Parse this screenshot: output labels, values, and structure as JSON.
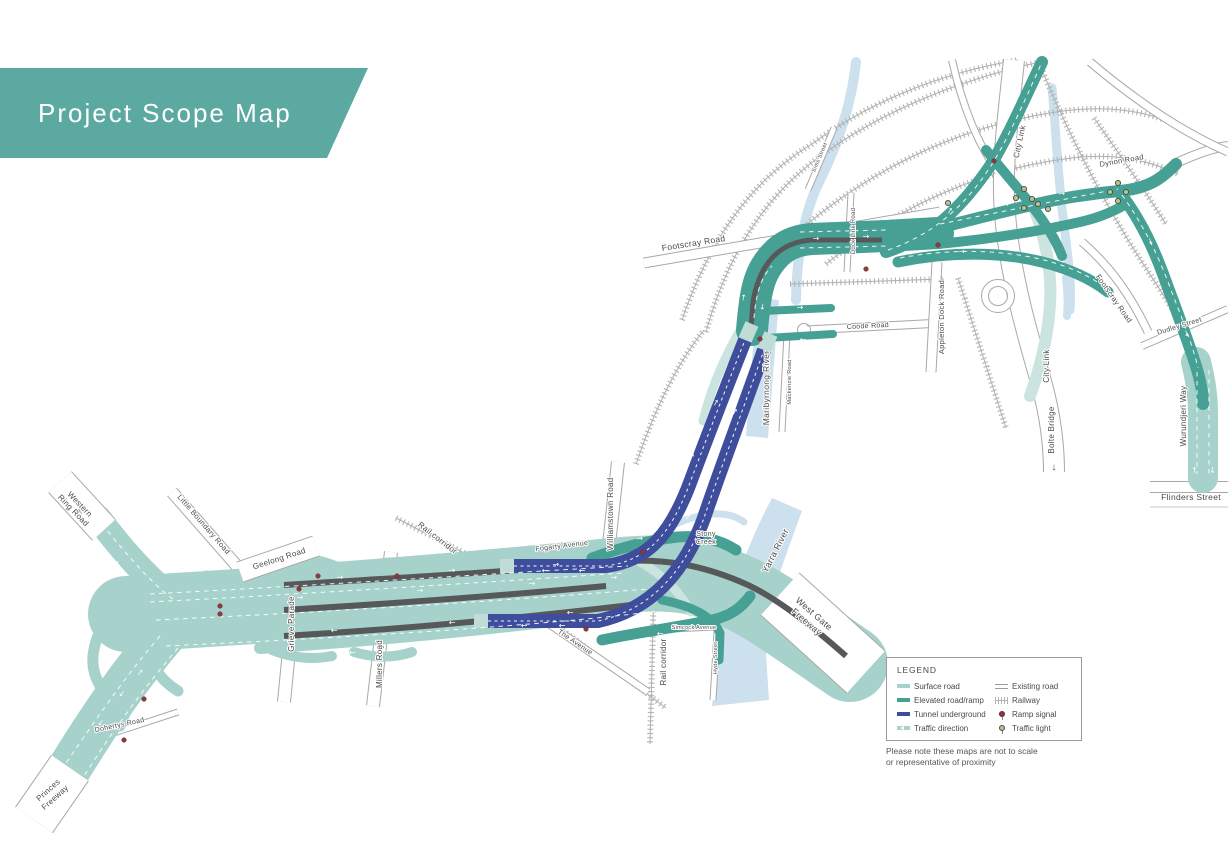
{
  "title": {
    "banner": "Project Scope Map"
  },
  "colors": {
    "banner_teal": "#5CA9A2",
    "surface_road": "#A7D2CB",
    "elevated_road": "#46A094",
    "tunnel_underground": "#3E4E9D",
    "existing_road_outline": "#9B9B9B",
    "railway": "#B3B3B3",
    "river": "#CCE1ED",
    "median_gray": "#57585A",
    "ramp_signal": "#8E3B3E",
    "traffic_light": "#B3C48A",
    "label_text": "#4A4A4A"
  },
  "icons": {
    "arrow": "→",
    "down_arrow": "↓"
  },
  "map": {
    "labels": {
      "western_ring_1": "Western",
      "western_ring_2": "Ring Road",
      "little_boundary": "Little Boundary Road",
      "geelong": "Geelong Road",
      "grieve": "Grieve Parade",
      "millers": "Millers Road",
      "rail_corridor_nw": "Rail corridor",
      "fogarty": "Fogarty Avenue",
      "williamstown": "Williamstown Road",
      "the_avenue": "The Avenue",
      "dohertys": "Dohertys Road",
      "princes_1": "Princes",
      "princes_2": "Freeway",
      "stony_1": "Stony",
      "stony_2": "Creek",
      "yarra": "Yarra River",
      "west_gate_1": "West Gate",
      "west_gate_2": "Freeway",
      "rail_corridor_s": "Rail corridor",
      "simcock": "Simcock Avenue",
      "hyde": "Hyde Street",
      "maribyrnong": "Maribyrnong River",
      "mackenzie": "Mackenzie Road",
      "coode": "Coode Road",
      "footscray_w": "Footscray Road",
      "sims": "Sims Street",
      "dock_link": "Dock Link Road",
      "appleton": "Appleton Dock Road",
      "city_link_n": "City Link",
      "city_link_s": "City Link",
      "bolte": "Bolte Bridge",
      "dynon": "Dynon Road",
      "footscray_e": "Footscray Road",
      "dudley": "Dudley Street",
      "wurundjeri": "Wurundjeri Way",
      "flinders": "Flinders Street"
    }
  },
  "legend": {
    "title": "LEGEND",
    "items": [
      {
        "name": "surface-road",
        "label": "Surface road"
      },
      {
        "name": "elevated-road-ramp",
        "label": "Elevated road/ramp"
      },
      {
        "name": "tunnel-underground",
        "label": "Tunnel underground"
      },
      {
        "name": "traffic-direction",
        "label": "Traffic direction"
      },
      {
        "name": "existing-road",
        "label": "Existing road"
      },
      {
        "name": "railway",
        "label": "Railway"
      },
      {
        "name": "ramp-signal",
        "label": "Ramp signal"
      },
      {
        "name": "traffic-light",
        "label": "Traffic light"
      }
    ],
    "note_line1": "Please note these maps are not to scale",
    "note_line2": "or representative of proximity"
  }
}
